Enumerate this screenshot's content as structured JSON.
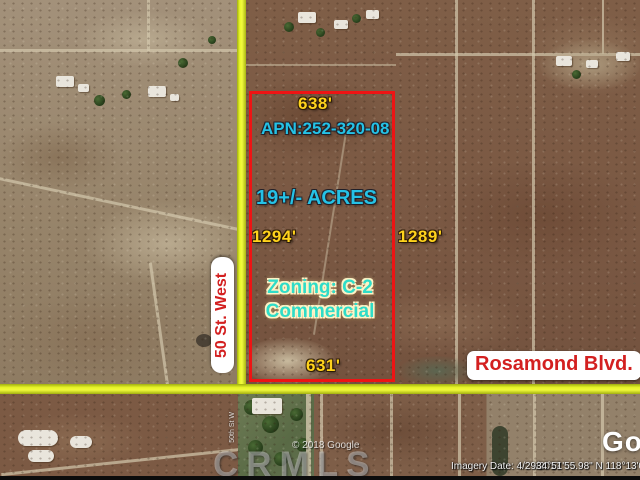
{
  "listing": {
    "apn": "APN:252-320-08",
    "acreage": "19+/- ACRES",
    "zoning_line1": "Zoning: C-2",
    "zoning_line2": "Commercial",
    "dimensions": {
      "top": "638'",
      "left": "1294'",
      "right": "1289'",
      "bottom": "631'"
    },
    "outline_color": "#ee1414"
  },
  "streets": {
    "vertical_sign": "50 St. West",
    "horizontal_sign": "Rosamond Blvd.",
    "faint_label": "50th St W",
    "highlight_color": "#eaf628",
    "sign_text_color": "#d32020"
  },
  "colors": {
    "dimension_text": "#ffd31c",
    "info_text": "#25c2e6",
    "zoning_text": "#2fdcc8"
  },
  "attribution": {
    "watermark": "CRMLS",
    "copyright": "© 2018 Google",
    "logo_partial": "Go",
    "imagery_date": "Imagery Date: 4/29/2017",
    "coordinates": "34°51'55.98\" N 118°13'09.08\" W"
  }
}
